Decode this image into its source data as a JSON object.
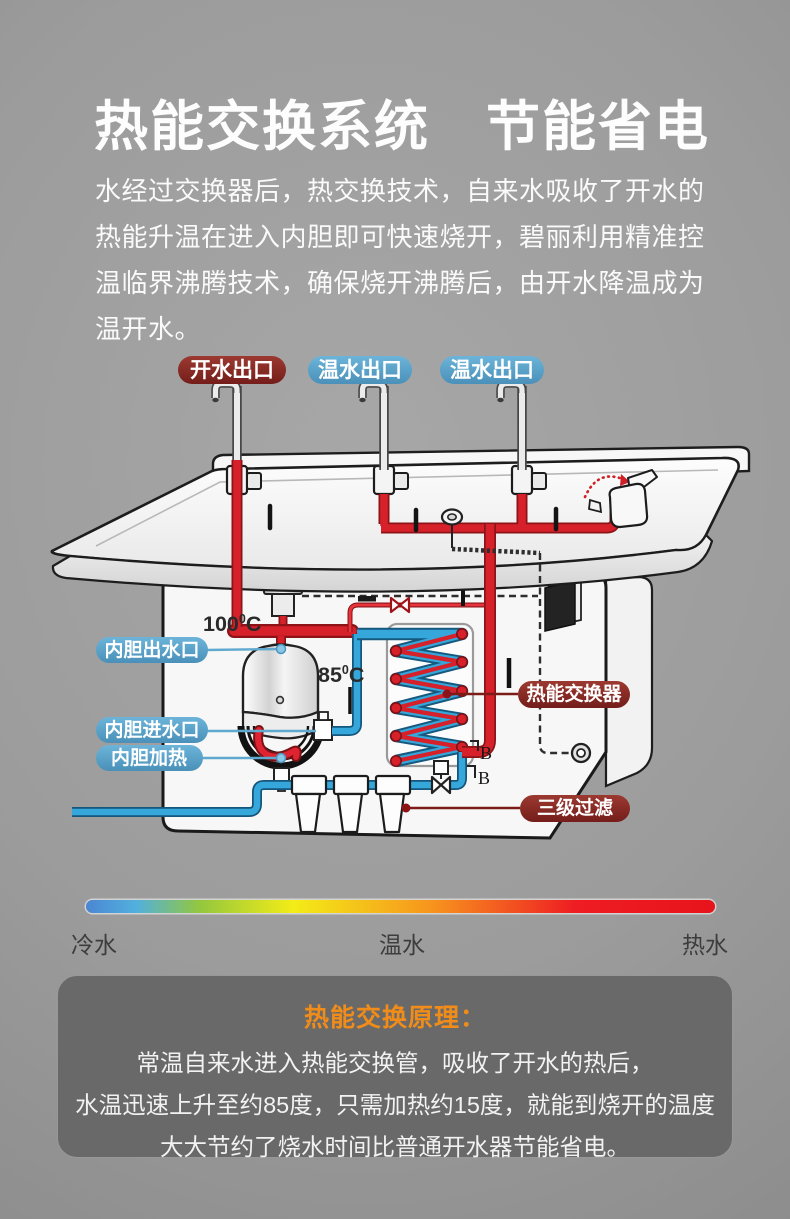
{
  "header": {
    "title": "热能交换系统　节能省电",
    "paragraph": [
      "水经过交换器后，热交换技术，自来水吸收了开水的",
      "热能升温在进入内胆即可快速烧开，碧丽利用精准控",
      "温临界沸腾技术，确保烧开沸腾后，由开水降温成为",
      "温开水。"
    ]
  },
  "diagram": {
    "outlets": [
      {
        "label": "开水出口",
        "type": "hot"
      },
      {
        "label": "温水出口",
        "type": "warm"
      },
      {
        "label": "温水出口",
        "type": "warm"
      }
    ],
    "labels": {
      "tank_outlet": "内胆出水口",
      "tank_inlet": "内胆进水口",
      "tank_heater": "内胆加热",
      "heat_exchanger": "热能交换器",
      "filter": "三级过滤"
    },
    "temps": {
      "boil_num": "100",
      "boil_deg": "0",
      "boil_unit": "C",
      "warm_num": "85",
      "warm_deg": "0",
      "warm_unit": "C"
    },
    "markers": {
      "b1": "B",
      "b2": "B"
    }
  },
  "temperature_scale": {
    "cold": "冷水",
    "warm": "温水",
    "hot": "热水"
  },
  "principle": {
    "title": "热能交换原理：",
    "lines": [
      "常温自来水进入热能交换管，吸收了开水的热后，",
      "水温迅速上升至约85度，只需加热约15度，就能到烧开的温度",
      "大大节约了烧水时间比普通开水器节能省电。"
    ]
  },
  "colors": {
    "hot_pipe": "#d6202a",
    "cold_pipe": "#36a7da",
    "hot_label_bg": "#84261f",
    "warm_label_bg": "#57a3c9",
    "accent_orange": "#f08c1a"
  }
}
